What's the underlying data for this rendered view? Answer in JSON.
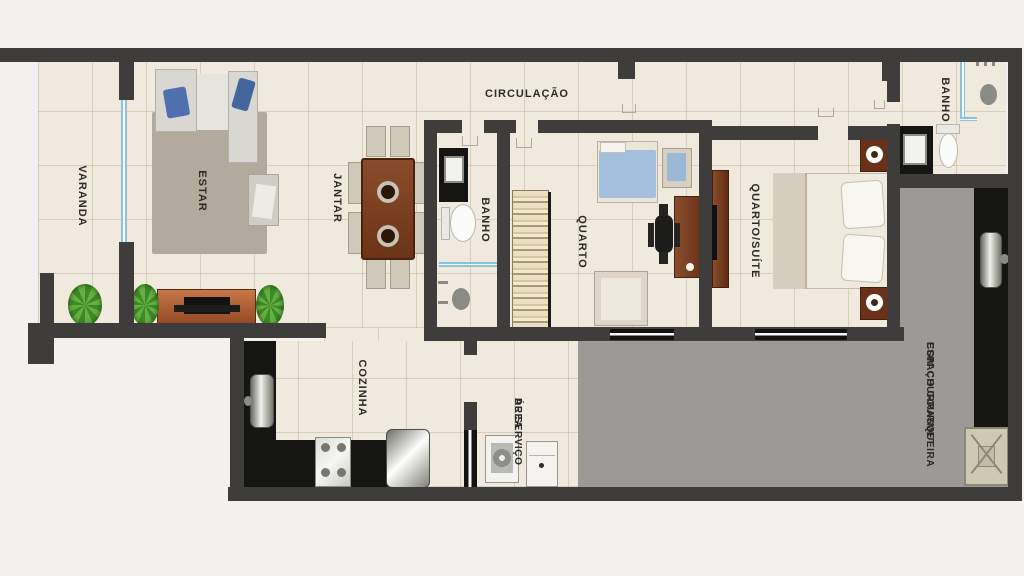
{
  "rooms": {
    "varanda": {
      "label": "VARANDA"
    },
    "estar": {
      "label": "ESTAR"
    },
    "jantar": {
      "label": "JANTAR"
    },
    "circulacao": {
      "label": "CIRCULAÇÃO"
    },
    "banho_social": {
      "label": "BANHO"
    },
    "quarto": {
      "label": "QUARTO"
    },
    "suite": {
      "label": "QUARTO/SUÍTE"
    },
    "banho_suite": {
      "label": "BANHO"
    },
    "cozinha": {
      "label": "COZINHA"
    },
    "area_servico": {
      "line1": "ÁREA",
      "line2": "DE SERVIÇO"
    },
    "gourmet": {
      "line1": "ESPAÇO GOURMET",
      "line2": "COM CHURRASQUEIRA"
    }
  },
  "colors": {
    "wall": "#3e3d3b",
    "floor": "#f0e9dd",
    "gourmet_floor": "#9b9a97",
    "counter": "#151514",
    "glass": "#8cc0de",
    "wood": "#7b4226",
    "accent_blue": "#4f6fae",
    "bed_blue": "#a4bfdb",
    "plant_green": "#4a9130",
    "rug": "#b2aa9d"
  }
}
